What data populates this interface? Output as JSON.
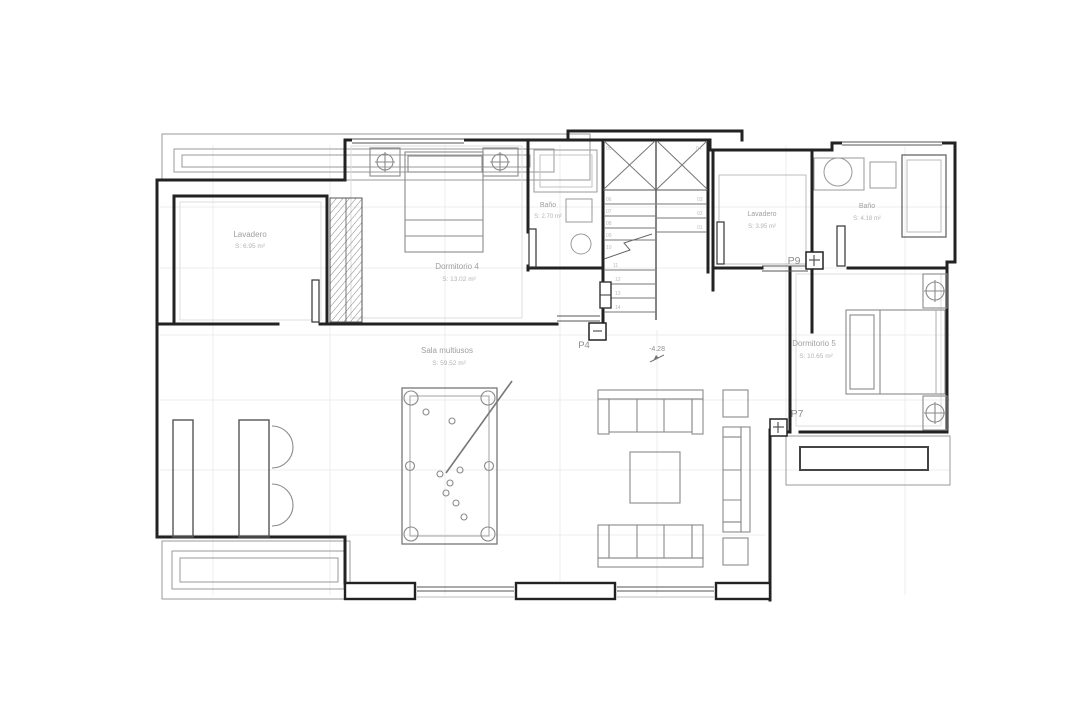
{
  "plan": {
    "type": "architectural floor plan",
    "colors": {
      "wall": "#222222",
      "furniture": "#8a8a8a",
      "label": "#9f9f9f",
      "grid": "#ebebeb"
    }
  },
  "rooms": {
    "lavadero_left": {
      "name": "Lavadero",
      "area": "S: 6.95 m²"
    },
    "dormitorio_4": {
      "name": "Dormitorio 4",
      "area": "S: 13.02 m²"
    },
    "bano_center": {
      "name": "Baño",
      "area": "S: 2.70 m²"
    },
    "lavadero_right": {
      "name": "Lavadero",
      "area": "S: 3.95 m²"
    },
    "bano_right": {
      "name": "Baño",
      "area": "S: 4.18 m²"
    },
    "dormitorio_5": {
      "name": "Dormitorio 5",
      "area": "S: 10.65 m²"
    },
    "sala_multiusos": {
      "name": "Sala multiusos",
      "area": "S: 59.52 m²"
    }
  },
  "doors": {
    "p4": "P4",
    "p7": "P7",
    "p9": "P9"
  },
  "level_marker": {
    "value": "-4.28"
  },
  "stairs": {
    "corner_left": "05",
    "corner_right": "04",
    "upper_left": [
      "06",
      "07",
      "08",
      "09",
      "10",
      "11"
    ],
    "lower_left": [
      "12",
      "13",
      "14"
    ],
    "right": [
      "03",
      "02",
      "01"
    ]
  }
}
